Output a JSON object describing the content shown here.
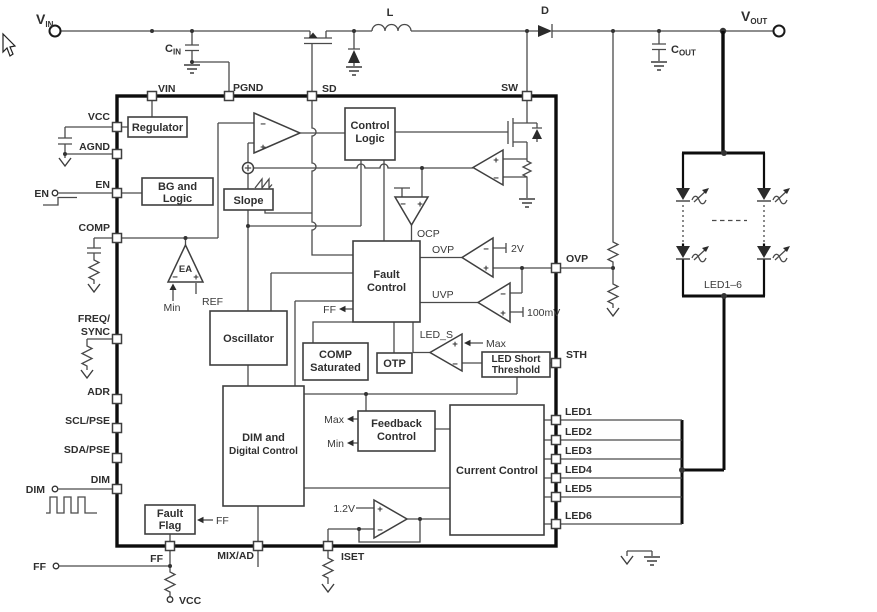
{
  "colors": {
    "wire": "#4a4a4a",
    "thick": "#0d0d0d",
    "text": "#2f2f2f",
    "background": "#ffffff"
  },
  "external": {
    "terminals": {
      "vin": {
        "base": "V",
        "sub": "IN"
      },
      "vout": {
        "base": "V",
        "sub": "OUT"
      },
      "en": "EN",
      "dim": "DIM",
      "ff": "FF",
      "vcc": "VCC"
    },
    "components": {
      "cin": {
        "base": "C",
        "sub": "IN"
      },
      "cout": {
        "base": "C",
        "sub": "OUT"
      },
      "inductor": "L",
      "diode": "D"
    },
    "led_string": "LED1–6"
  },
  "ic": {
    "pins": {
      "top": [
        "VIN",
        "PGND",
        "SD",
        "SW"
      ],
      "left": [
        "VCC",
        "AGND",
        "EN",
        "COMP",
        "FREQ/",
        "SYNC",
        "ADR",
        "SCL/PSE",
        "SDA/PSE",
        "DIM"
      ],
      "bottom": [
        "FF",
        "MIX/AD",
        "ISET"
      ],
      "right": [
        "OVP",
        "STH",
        "LED1",
        "LED2",
        "LED3",
        "LED4",
        "LED5",
        "LED6"
      ]
    },
    "blocks": {
      "regulator": "Regulator",
      "bg_logic": {
        "l1": "BG and",
        "l2": "Logic"
      },
      "slope": "Slope",
      "control_logic": {
        "l1": "Control",
        "l2": "Logic"
      },
      "fault_control": {
        "l1": "Fault",
        "l2": "Control"
      },
      "oscillator": "Oscillator",
      "comp_saturated": {
        "l1": "COMP",
        "l2": "Saturated"
      },
      "otp": "OTP",
      "led_short_threshold": {
        "l1": "LED Short",
        "l2": "Threshold"
      },
      "dim_digital": {
        "l1": "DIM and",
        "l2": "Digital Control"
      },
      "feedback": {
        "l1": "Feedback",
        "l2": "Control"
      },
      "current_control": "Current Control",
      "fault_flag": {
        "l1": "Fault",
        "l2": "Flag"
      }
    }
  },
  "signals": {
    "ea": "EA",
    "min_ea": "Min",
    "ref": "REF",
    "ocp": "OCP",
    "ovp": "OVP",
    "uvp": "UVP",
    "ovp_threshold": "2V",
    "uvp_threshold": "100mV",
    "led_s": "LED_S",
    "max_led": "Max",
    "ff_fault": "FF",
    "ff_flag": "FF",
    "max_fb": "Max",
    "min_fb": "Min",
    "vref": "1.2V"
  },
  "glyphs": {
    "plus": "+",
    "minus": "−"
  }
}
